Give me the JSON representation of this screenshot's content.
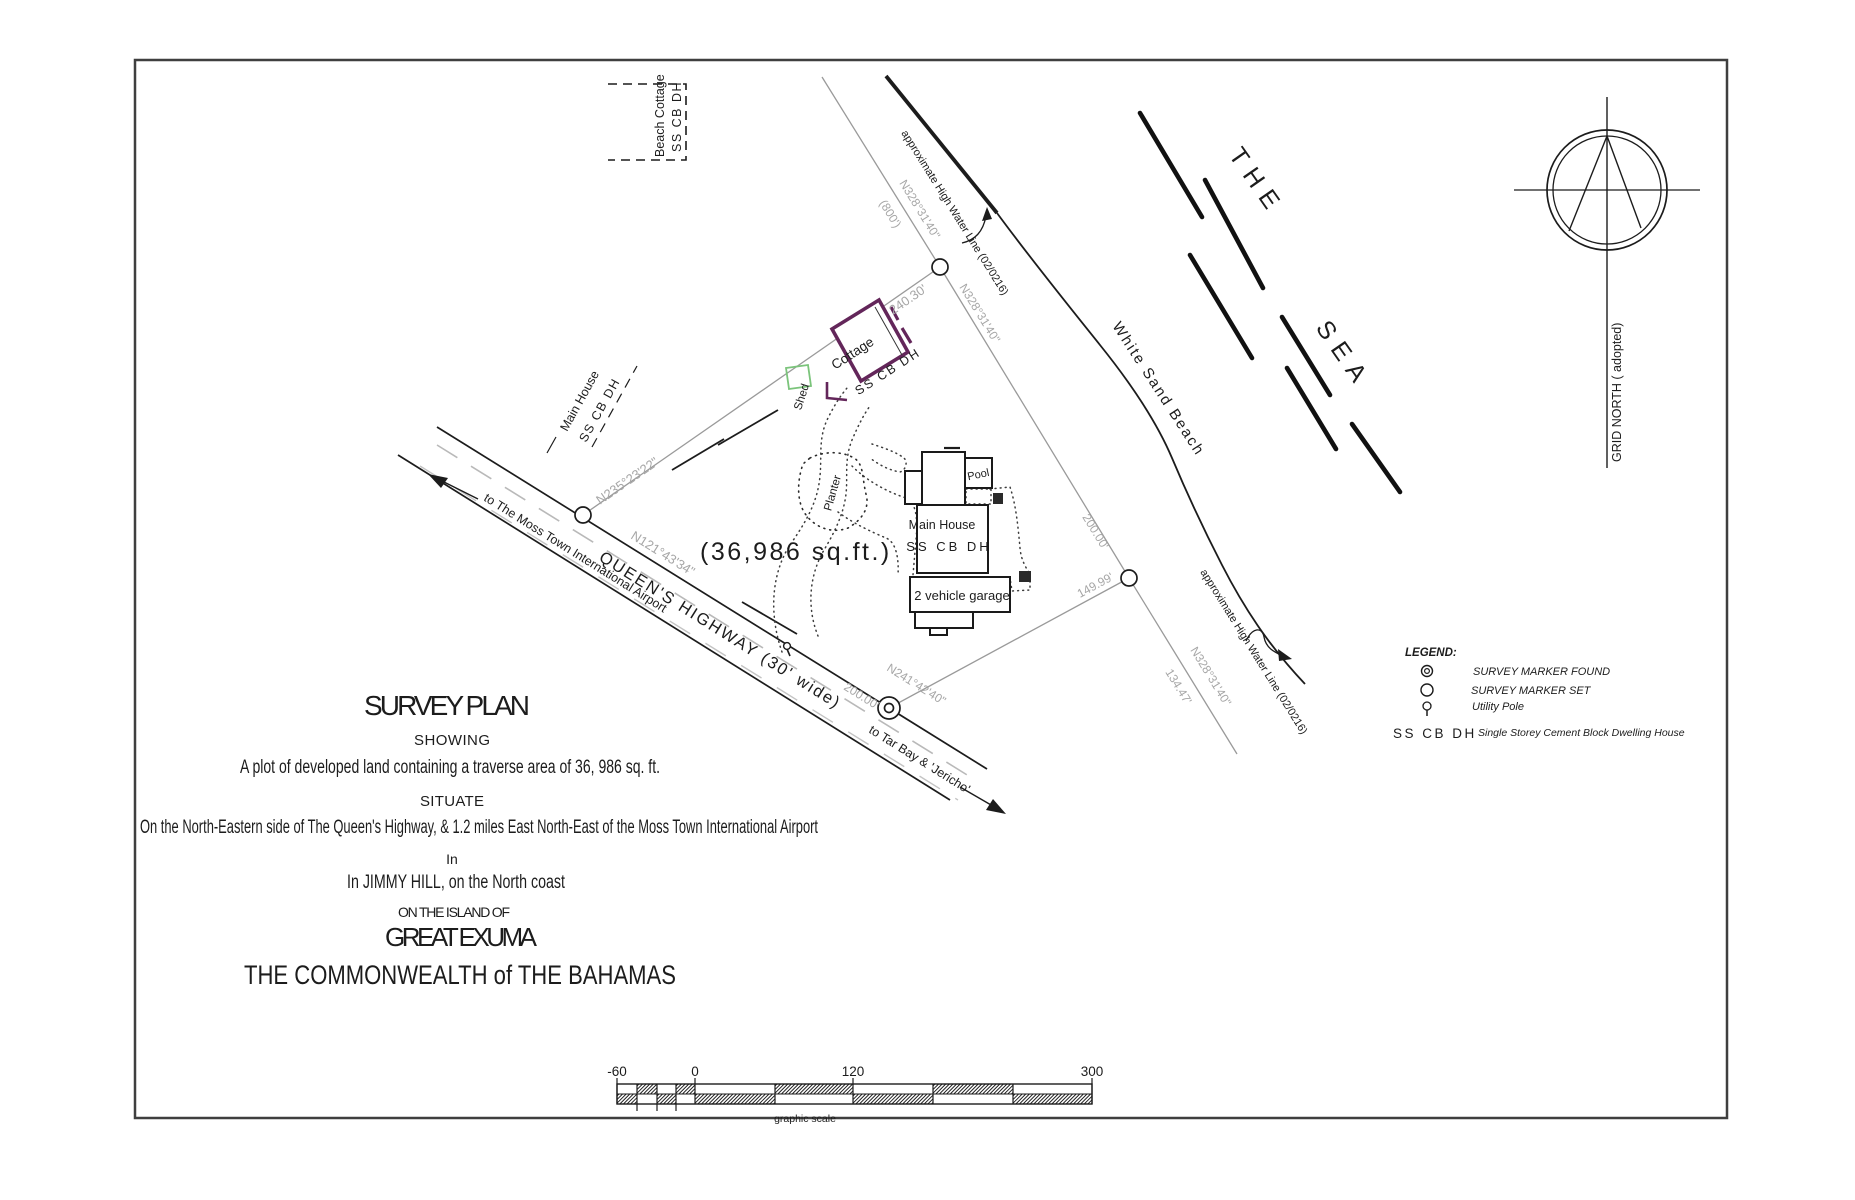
{
  "colors": {
    "ink": "#1c1c1c",
    "boundary_gray": "#9a9a9a",
    "dim_text_gray": "#a6a6a6",
    "cottage_outline": "#63265a",
    "shed_outline": "#7bc47b"
  },
  "labels": {
    "beach_cottage_1": "Beach Cottage",
    "beach_cottage_2": "SS CB DH",
    "neighbor_house_1": "Main House",
    "neighbor_house_2": "SS CB DH",
    "grid_north": "GRID NORTH ( adopted)",
    "the": "THE",
    "sea": "SEA",
    "white_sand_beach": "White Sand Beach",
    "hwl_top": "approximate High Water Line (02/0216)",
    "hwl_bottom": "approximate High Water Line (02/0216)",
    "area": "(36,986  sq.ft.)",
    "cottage": "Cottage",
    "cottage_type": "SS CB DH",
    "shed": "Shed",
    "planter": "Planter",
    "pool": "Pool",
    "main_house": "Main House",
    "main_house_type": "SS CB DH",
    "garage": "2 vehicle garage",
    "road_name": "QUEEN'S HIGHWAY (30' wide)",
    "to_airport": "to The Moss Town International Airport",
    "to_tarbay": "to Tar Bay & 'Jericho'"
  },
  "dimensions": {
    "nw_bearing": "N235°23'22\"",
    "nw_length": "240.30'",
    "ne_bearing": "N328°31'40\"",
    "ne_parenthetical": "(800')",
    "ne_length": "200.00'",
    "road_length": "200.00'",
    "road_bearing": "N241°42'40\"",
    "se_length": "149.99'",
    "ext_bearing": "N328°31'40\"",
    "ext_length": "134.47'",
    "hwy_bearing": "N121°43'34\""
  },
  "legend": {
    "title": "LEGEND:",
    "items": [
      {
        "symbol": "survey-marker-found",
        "label": "SURVEY MARKER FOUND"
      },
      {
        "symbol": "survey-marker-set",
        "label": "SURVEY MARKER SET"
      },
      {
        "symbol": "utility-pole",
        "label": "Utility Pole"
      }
    ],
    "abbr": "SS CB DH",
    "abbr_label": "Single Storey Cement Block Dwelling House"
  },
  "title_block": {
    "title": "SURVEY   PLAN",
    "showing": "SHOWING",
    "description": "A plot of developed land containing a traverse area of 36, 986 sq. ft.",
    "situate": "SITUATE",
    "location": "On the North-Eastern side of The Queen's Highway, & 1.2 miles East North-East of the Moss Town International Airport",
    "in_word": "In",
    "settlement": "In JIMMY HILL, on the North coast",
    "island_of": "ON  THE  ISLAND  OF",
    "island": "GREAT  EXUMA",
    "country": "THE  COMMONWEALTH  of  THE  BAHAMAS"
  },
  "scale_bar": {
    "labels": [
      "-60",
      "0",
      "120",
      "300"
    ],
    "caption": "graphic scale"
  }
}
